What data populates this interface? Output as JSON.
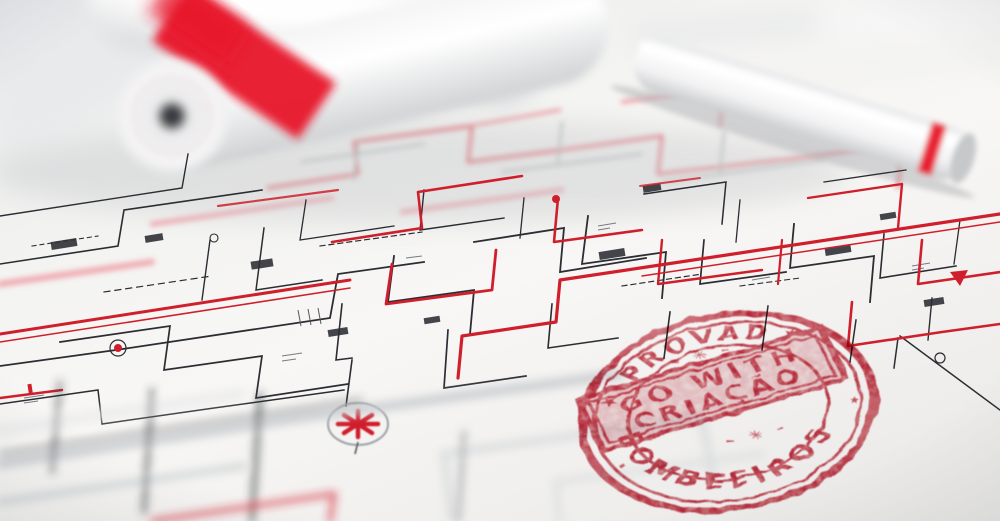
{
  "stamp": {
    "arc_top_text": "APROVADO",
    "arc_bottom_text": "BOMBEEIROS",
    "banner_line_1": "GO WITH",
    "banner_line_2": "CRIAÇÃO",
    "star_left_glyph": "★",
    "star_right_glyph": "★",
    "mark_bottom_left_glyph": "▪",
    "star_bottom_right_glyph": "★",
    "ornament_top_glyph": "– ✳ –",
    "ornament_bottom_glyph": "– ✳ –",
    "ink_color": "#bb1f30"
  },
  "palette": {
    "paper": "#f4f3f1",
    "plan_line_dark": "#2b2d33",
    "plan_line_red": "#d01f2c",
    "plan_line_soft_pink": "#ef9aa3",
    "roll_band_red": "#e8192c",
    "stamp_red": "#bb1f30"
  }
}
